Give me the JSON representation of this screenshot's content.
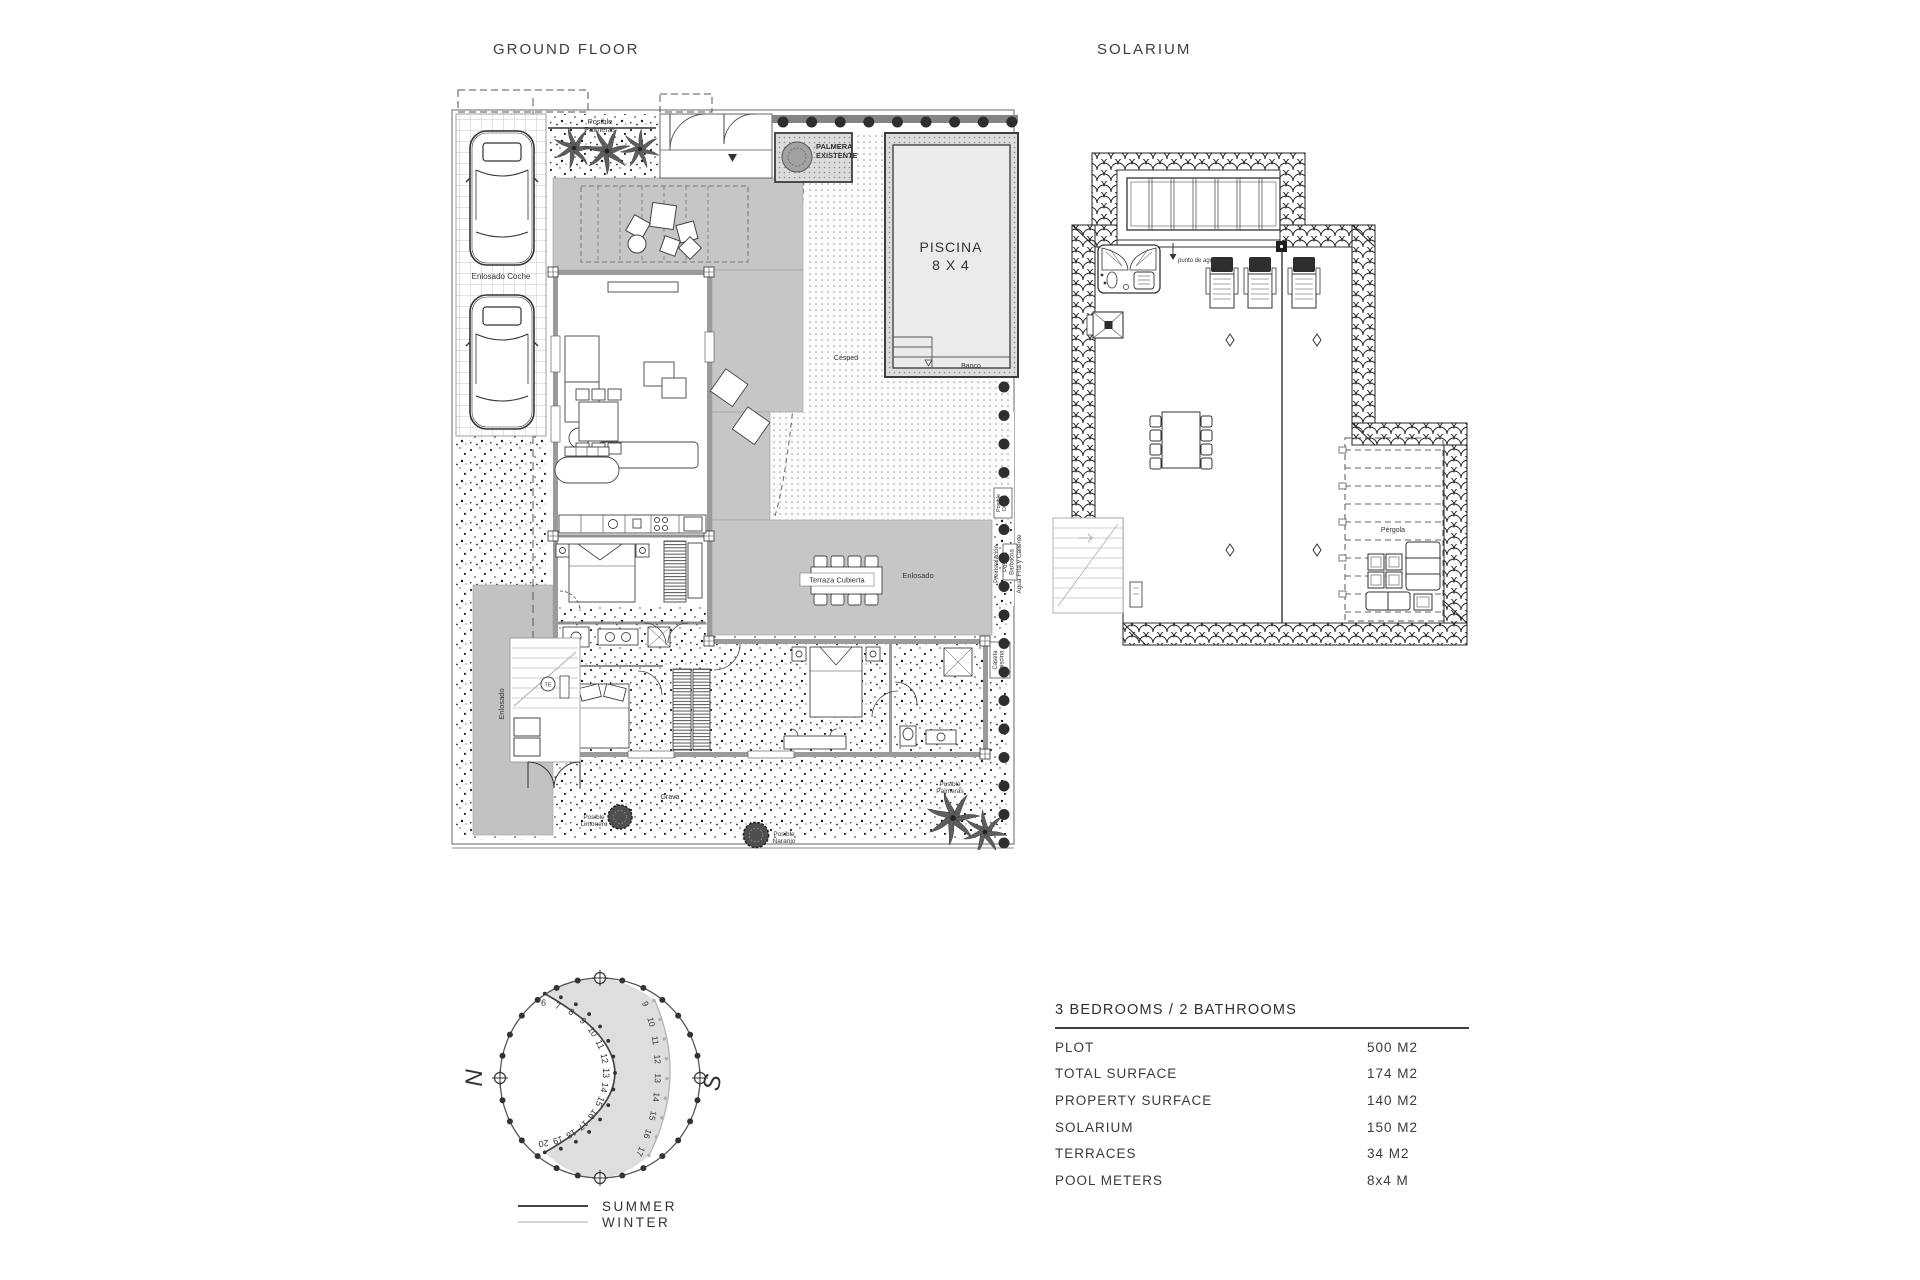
{
  "page": {
    "background": "#ffffff"
  },
  "ground_floor": {
    "title": "GROUND FLOOR",
    "labels": {
      "enlosado_coche": "Enlosado Coche",
      "posible_palmeras_top": "Posible Palmeras",
      "palmera_existente": "PALMERA EXISTENTE",
      "piscina": "PISCINA",
      "piscina_size": "8 X 4",
      "banco": "Banco",
      "cesped": "Césped",
      "terraza_cubierta": "Terraza Cubierta",
      "enlosado_terrace": "Enlosado",
      "preinstalacion": "Preinstalación",
      "posible_barbacoa": "Posible Barbacoa",
      "agua_fria": "Agua Fría y Caliente",
      "posible_ducha": "Posible Ducha",
      "enlosado_entry": "Enlosado",
      "te": "TE",
      "caseta_piscina": "Caseta piscina",
      "posible_limonero": "Posible Limonero",
      "grava": "Grava",
      "posible_naranjo": "Posible Naranjo",
      "posible_palmeras_bottom": "Posible Palmeras"
    }
  },
  "solarium": {
    "title": "SOLARIUM",
    "labels": {
      "punto_de_agua": "punto de agua",
      "pergola": "Pérgola"
    }
  },
  "compass": {
    "north": "N",
    "south": "S",
    "summer_label": "SUMMER",
    "winter_label": "WINTER",
    "summer_hours": [
      6,
      7,
      8,
      9,
      10,
      11,
      12,
      13,
      14,
      15,
      16,
      17,
      18,
      19,
      20
    ],
    "winter_hours": [
      9,
      10,
      11,
      12,
      13,
      14,
      15,
      16,
      17
    ]
  },
  "specs": {
    "header": "3 BEDROOMS / 2 BATHROOMS",
    "rows": [
      {
        "label": "PLOT",
        "value": "500 M2"
      },
      {
        "label": "TOTAL SURFACE",
        "value": "174 M2"
      },
      {
        "label": "PROPERTY SURFACE",
        "value": "140 M2"
      },
      {
        "label": "SOLARIUM",
        "value": "150 M2"
      },
      {
        "label": "TERRACES",
        "value": "34 M2"
      },
      {
        "label": "POOL METERS",
        "value": "8x4 M"
      }
    ]
  },
  "colors": {
    "terrace_gray": "#c6c6c6",
    "wall_gray": "#9b9b9b",
    "pool_water": "#ebebeb",
    "bush_dark": "#2e2e2e",
    "winter_gray": "#b3b3b3",
    "summer_dark": "#444444",
    "crescent_fill": "#dedede"
  }
}
